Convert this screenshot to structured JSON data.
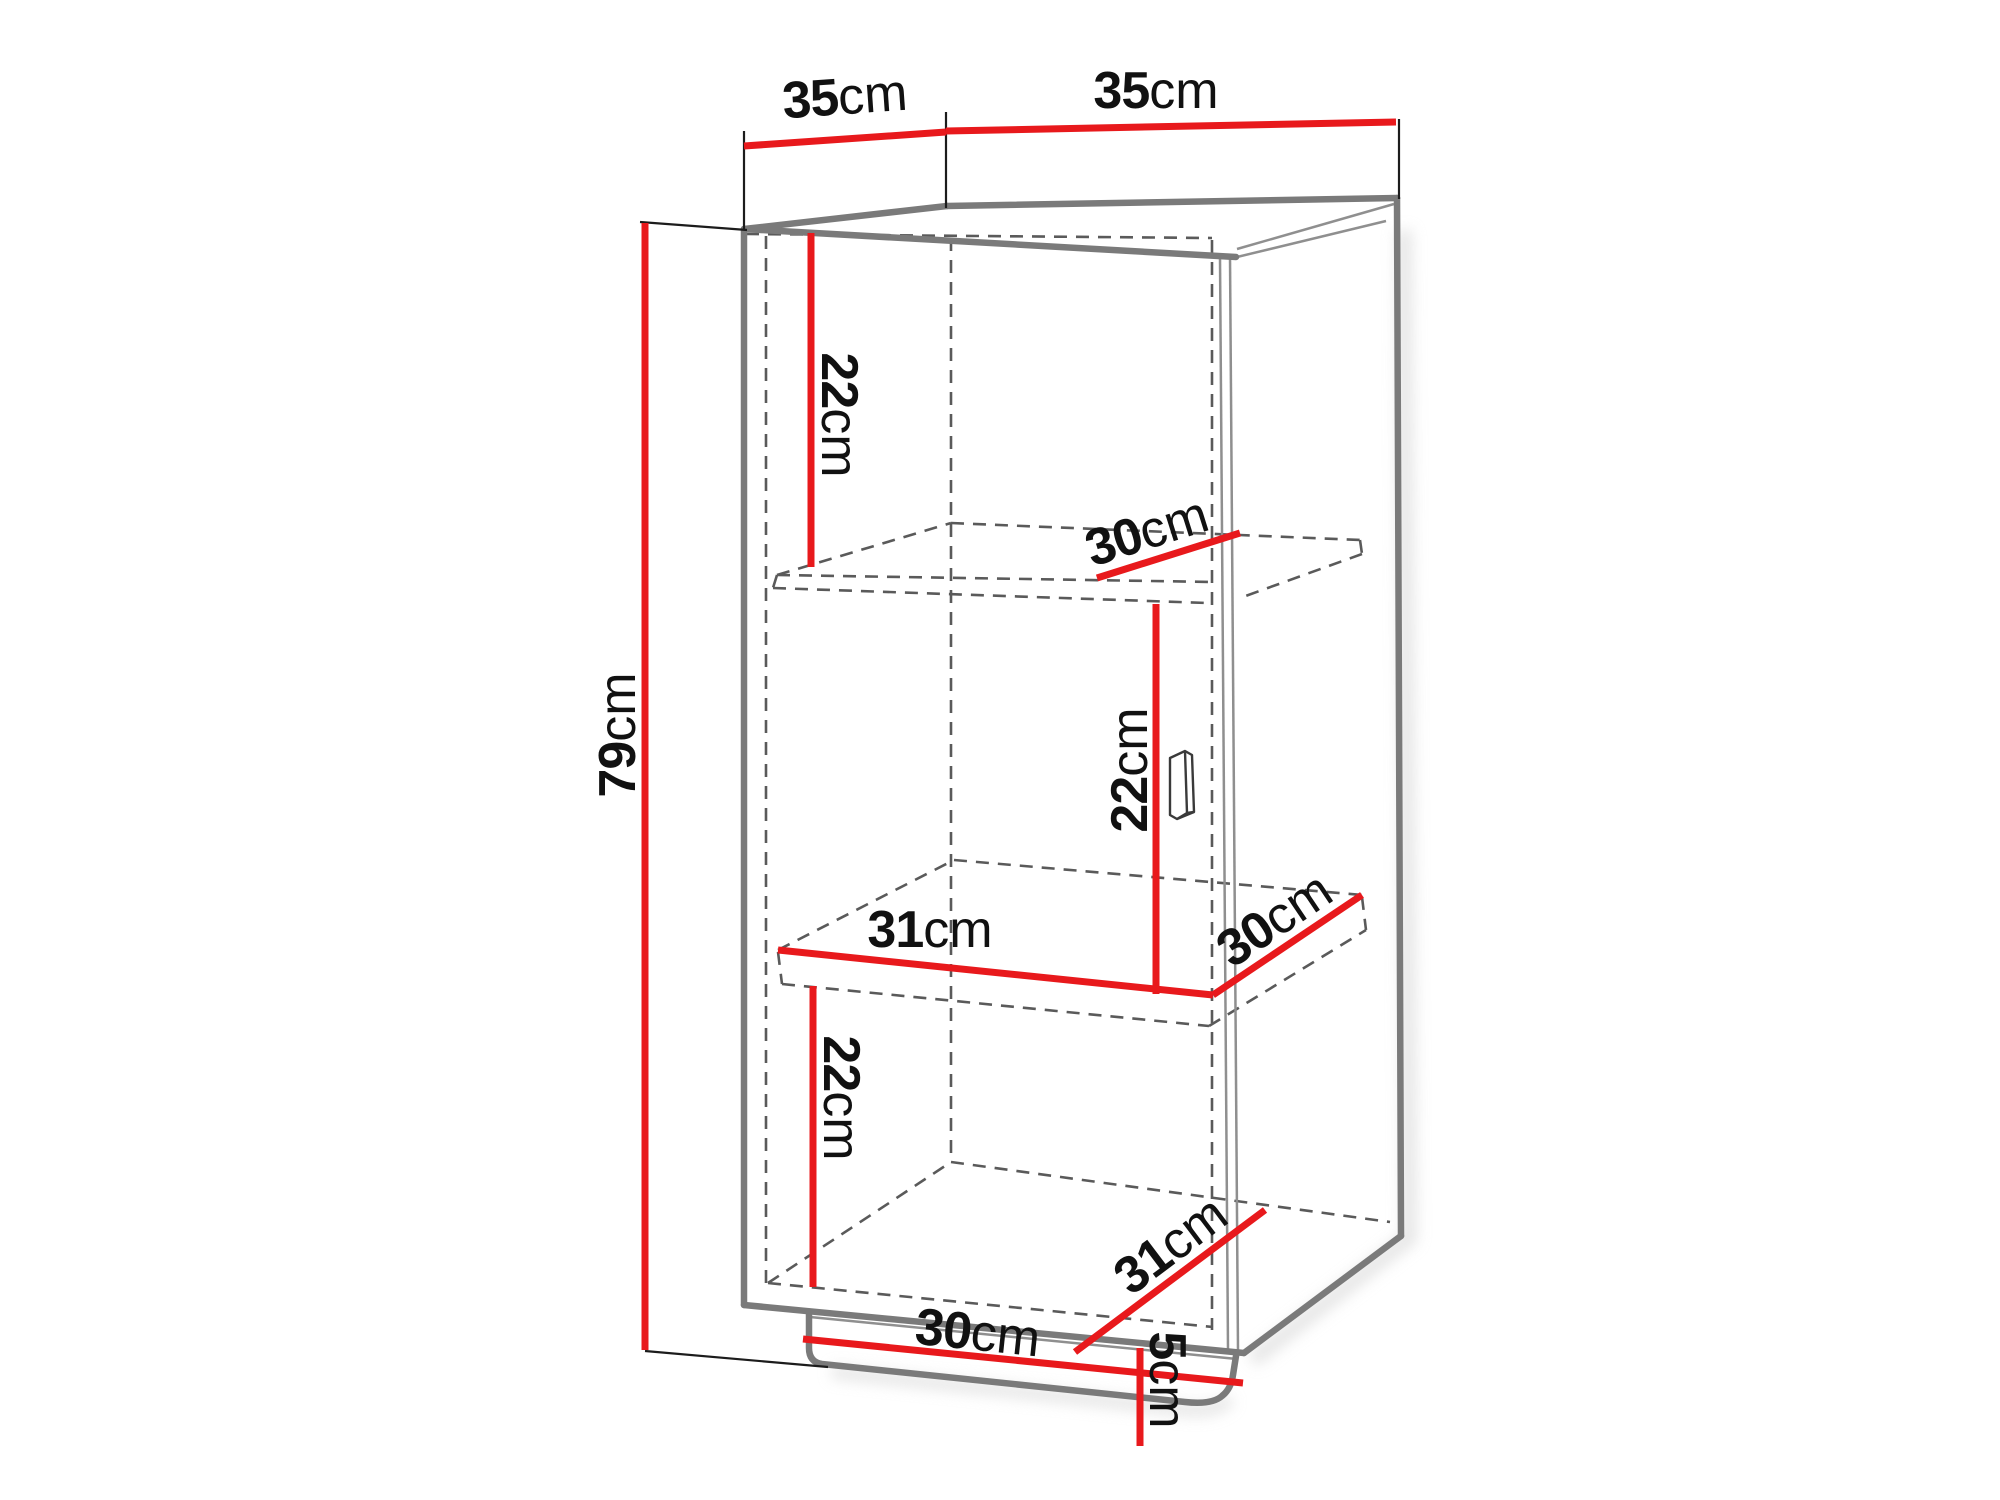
{
  "diagram": {
    "kind": "furniture-dimension-diagram",
    "subject": "single-door cabinet with two shelves on plinth base",
    "background": "#ffffff"
  },
  "colors": {
    "dimension_red": "#e8191c",
    "outline_gray": "#7a7a7a",
    "inner_gray": "#8f8f8f",
    "hidden_gray": "#5a5a5a",
    "tick_black": "#1c1c1c",
    "text_black": "#111111",
    "shadow_gray": "#d2d2d2",
    "handle_outline": "#3a3a3a"
  },
  "labels": {
    "top_depth": {
      "num": "35",
      "unit": "cm"
    },
    "top_width": {
      "num": "35",
      "unit": "cm"
    },
    "height": {
      "num": "79",
      "unit": "cm"
    },
    "upper_compartment": {
      "num": "22",
      "unit": "cm"
    },
    "upper_shelf_depth": {
      "num": "30",
      "unit": "cm"
    },
    "middle_compartment": {
      "num": "22",
      "unit": "cm"
    },
    "middle_shelf_width": {
      "num": "31",
      "unit": "cm"
    },
    "middle_shelf_depth": {
      "num": "30",
      "unit": "cm"
    },
    "lower_compartment": {
      "num": "22",
      "unit": "cm"
    },
    "bottom_depth": {
      "num": "31",
      "unit": "cm"
    },
    "plinth_width": {
      "num": "30",
      "unit": "cm"
    },
    "plinth_height": {
      "num": "5",
      "unit": "cm"
    }
  }
}
